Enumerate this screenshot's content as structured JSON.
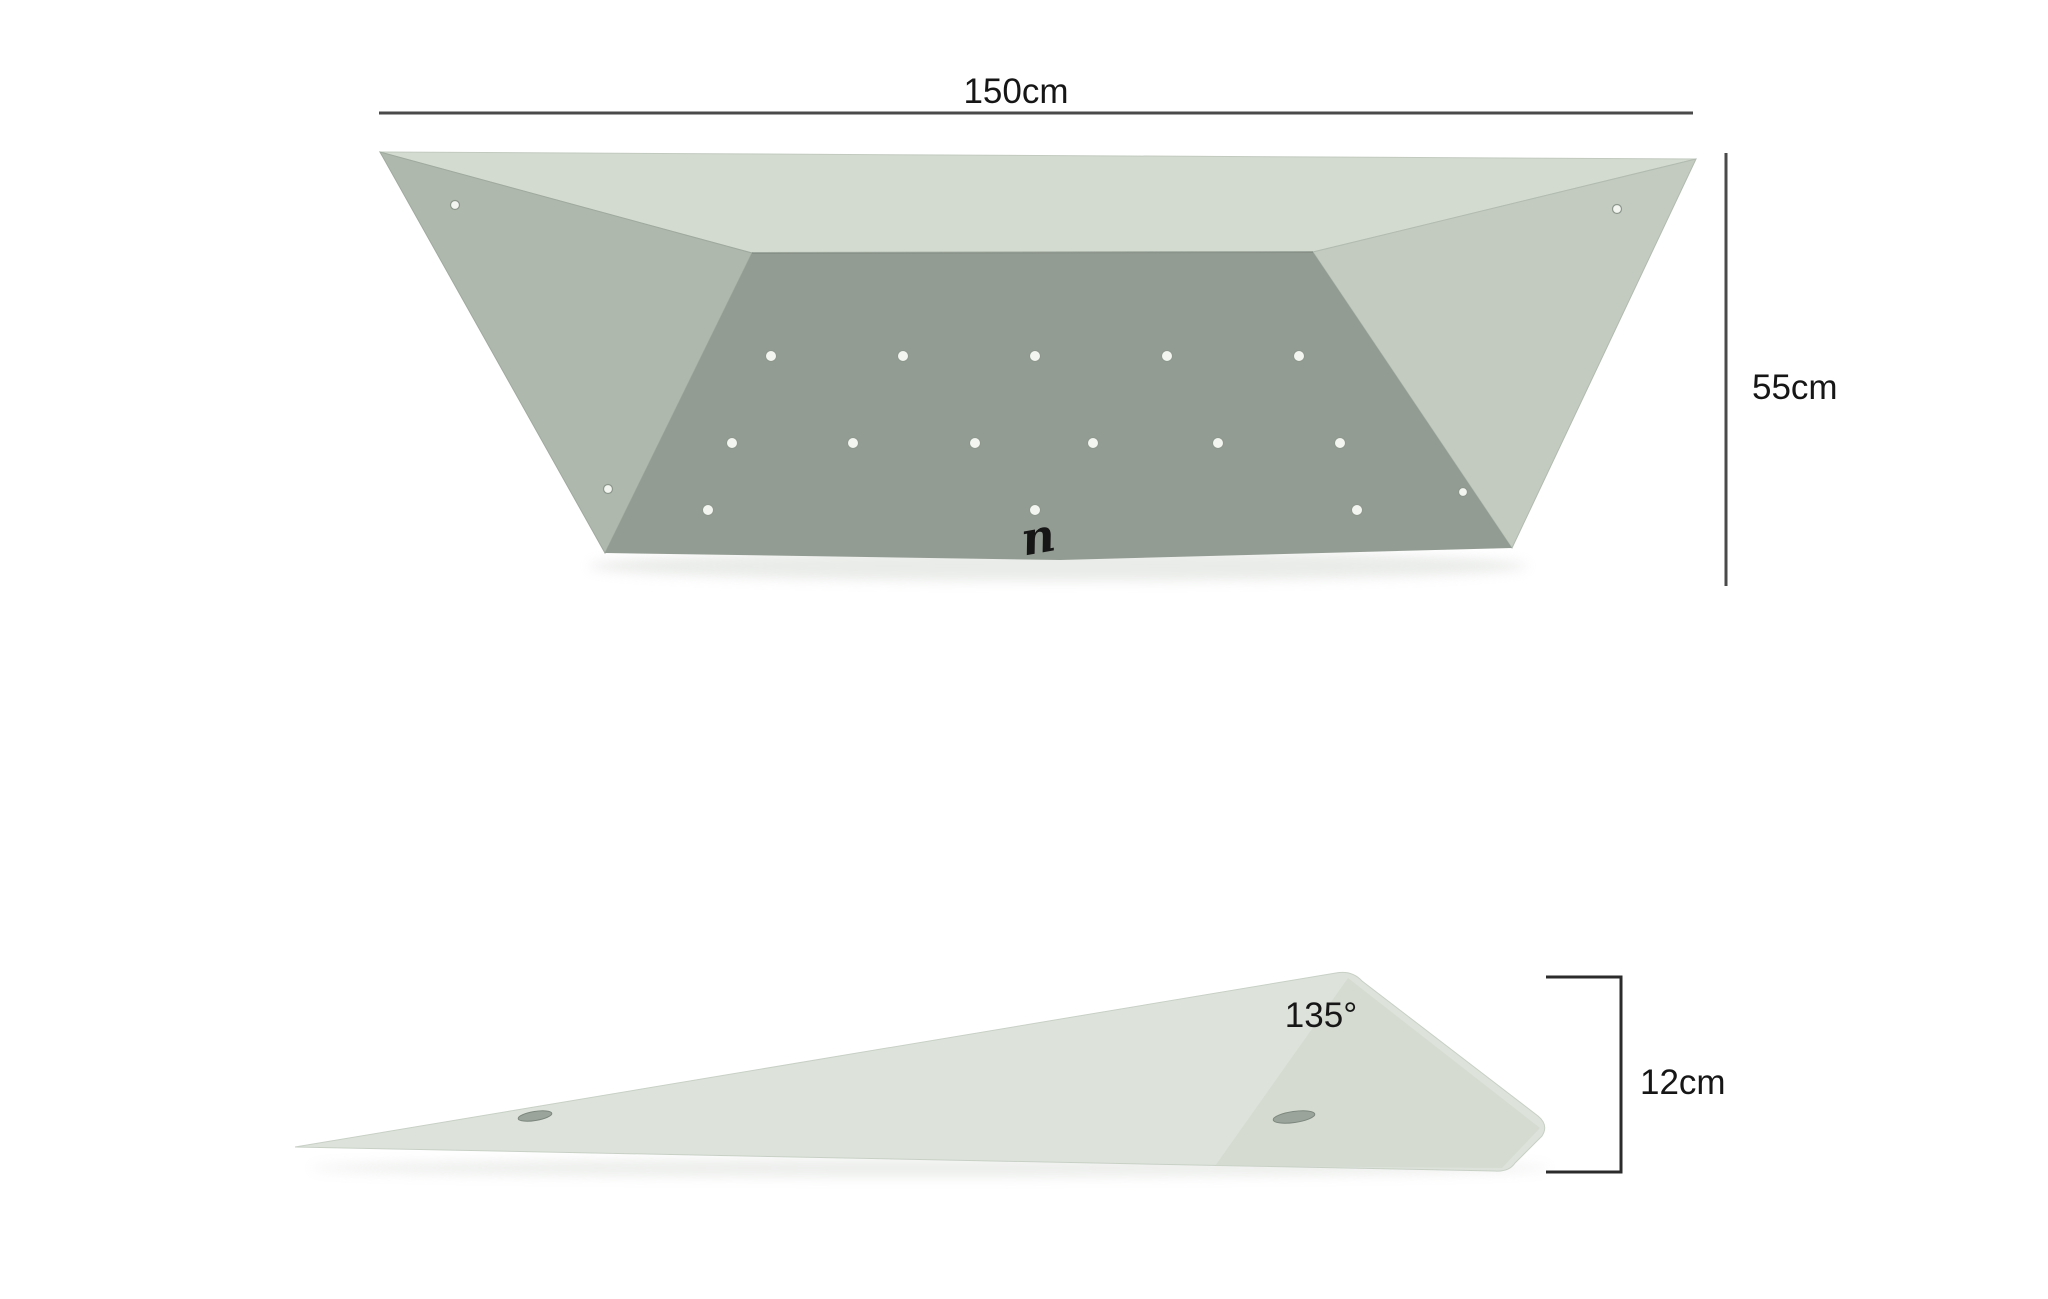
{
  "dimensions": {
    "width_label": "150cm",
    "height_label": "55cm",
    "angle_label": "135°",
    "thickness_label": "12cm"
  },
  "logo": {
    "glyph": "n"
  },
  "colors": {
    "background": "#ffffff",
    "dim_line": "#4a4a4a",
    "bracket_line": "#2b2b2b",
    "top_face": "#d3dad0",
    "left_face": "#aeb8ad",
    "right_face": "#c3cbc0",
    "front_face": "#939c93",
    "front_face_edge": "#7e887e",
    "side_body": "#dde3da",
    "side_end_face": "#cdd5cb",
    "hole_fill": "#f2f5f0",
    "hole_ring": "#8d978c",
    "side_hole_fill": "#9aa49b",
    "side_hole_ring": "#7d877e",
    "shadow": "#c9cfc8",
    "logo_color": "#4b5450"
  },
  "figure": {
    "type": "product-dimension-diagram",
    "subject": "climbing wall volume — top view and side profile",
    "top_view": {
      "front_hole_rows": [
        {
          "y": 356,
          "x": [
            771,
            903,
            1035,
            1167,
            1299
          ],
          "r": 5.5
        },
        {
          "y": 443,
          "x": [
            732,
            853,
            975,
            1093,
            1218,
            1340
          ],
          "r": 5.5
        },
        {
          "y": 510,
          "x": [
            708,
            1035,
            1357
          ],
          "r": 5.5
        }
      ],
      "slant_holes": [
        {
          "x": 455,
          "y": 205,
          "r": 4.5
        },
        {
          "x": 608,
          "y": 489,
          "r": 4.5
        },
        {
          "x": 1617,
          "y": 209,
          "r": 4.5
        },
        {
          "x": 1463,
          "y": 492,
          "r": 4.5
        }
      ]
    },
    "side_view": {
      "holes": [
        {
          "cx": 535,
          "cy": 1116,
          "rx": 17,
          "ry": 4.5,
          "rot": -9
        },
        {
          "cx": 1294,
          "cy": 1117,
          "rx": 21,
          "ry": 5.5,
          "rot": -8
        }
      ]
    }
  }
}
